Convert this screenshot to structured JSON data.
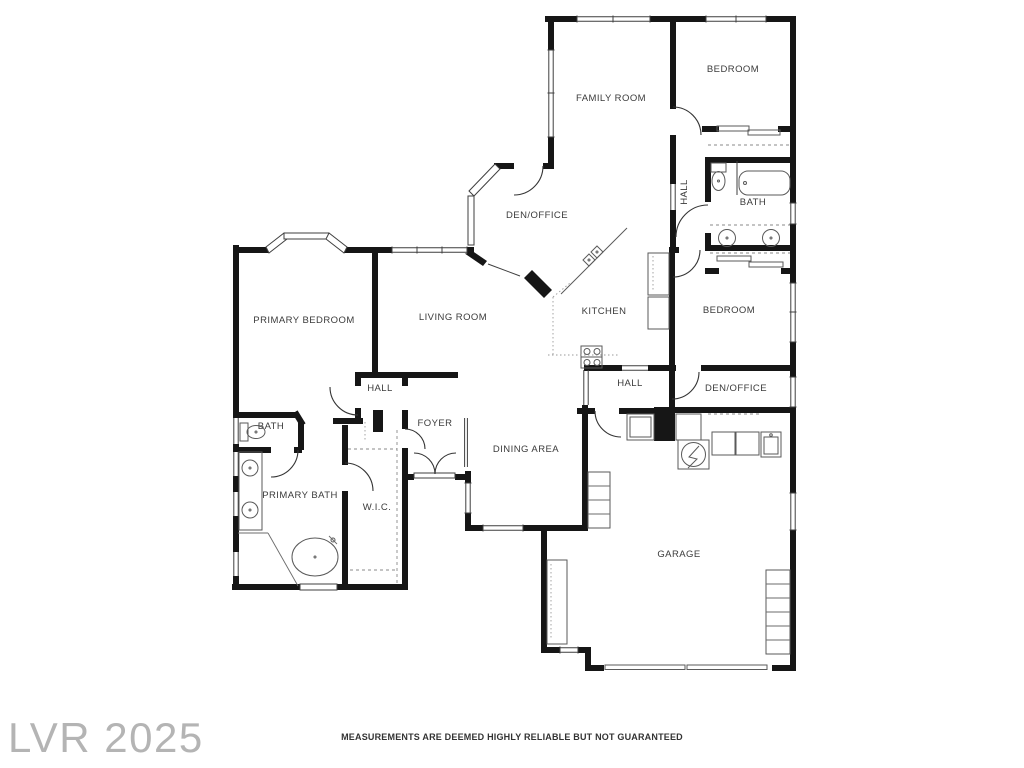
{
  "watermark": {
    "text": "LVR 2025",
    "color": "#b4b4b4"
  },
  "disclaimer": {
    "text": "MEASUREMENTS ARE DEEMED HIGHLY RELIABLE BUT NOT GUARANTEED"
  },
  "colors": {
    "walls": "#161616",
    "label_text": "#3b3b3b",
    "background": "#ffffff"
  },
  "floorplan": {
    "type": "single-family residence floor plan",
    "rooms": [
      {
        "id": "family-room",
        "label": "FAMILY ROOM"
      },
      {
        "id": "bedroom-1",
        "label": "BEDROOM"
      },
      {
        "id": "hall-1",
        "label": "HALL"
      },
      {
        "id": "bath-1",
        "label": "BATH"
      },
      {
        "id": "den-office-1",
        "label": "DEN/OFFICE"
      },
      {
        "id": "primary-bedroom",
        "label": "PRIMARY BEDROOM"
      },
      {
        "id": "living-room",
        "label": "LIVING ROOM"
      },
      {
        "id": "kitchen",
        "label": "KITCHEN"
      },
      {
        "id": "bedroom-2",
        "label": "BEDROOM"
      },
      {
        "id": "hall-2",
        "label": "HALL"
      },
      {
        "id": "hall-3",
        "label": "HALL"
      },
      {
        "id": "den-office-2",
        "label": "DEN/OFFICE"
      },
      {
        "id": "bath-2",
        "label": "BATH"
      },
      {
        "id": "foyer",
        "label": "FOYER"
      },
      {
        "id": "dining-area",
        "label": "DINING AREA"
      },
      {
        "id": "primary-bath",
        "label": "PRIMARY BATH"
      },
      {
        "id": "wic",
        "label": "W.I.C."
      },
      {
        "id": "garage",
        "label": "GARAGE"
      }
    ]
  }
}
